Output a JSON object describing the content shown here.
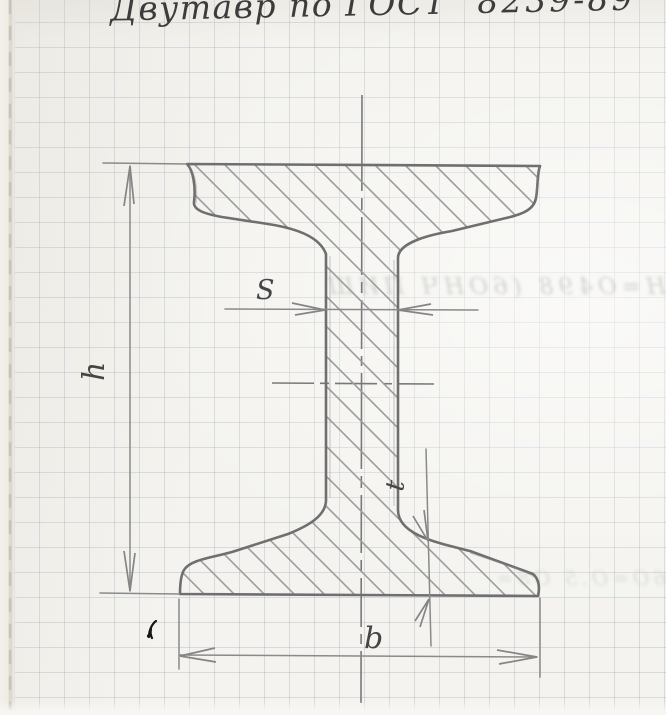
{
  "title": {
    "text_left": "Двутавр по ГОСТ",
    "text_right": "8239-89"
  },
  "diagram": {
    "labels": {
      "height": "h",
      "flange_width": "b",
      "web_thickness": "S",
      "flange_thickness": "t"
    }
  },
  "artifacts": {
    "bleed_top": "Н=О498 (6ОНЧ ПИШ",
    "bleed_bottom": "6О=О.5 О8="
  },
  "colors": {
    "paper": "#f4f3ef",
    "grid": "#96a0af",
    "pencil_outline": "#6f6f6f",
    "pencil_hatch": "#9c9c9c",
    "pencil_dim": "#8a8a8a",
    "label_text": "#454545",
    "title_text": "#3c3c3c",
    "ink_mark": "#151515"
  }
}
